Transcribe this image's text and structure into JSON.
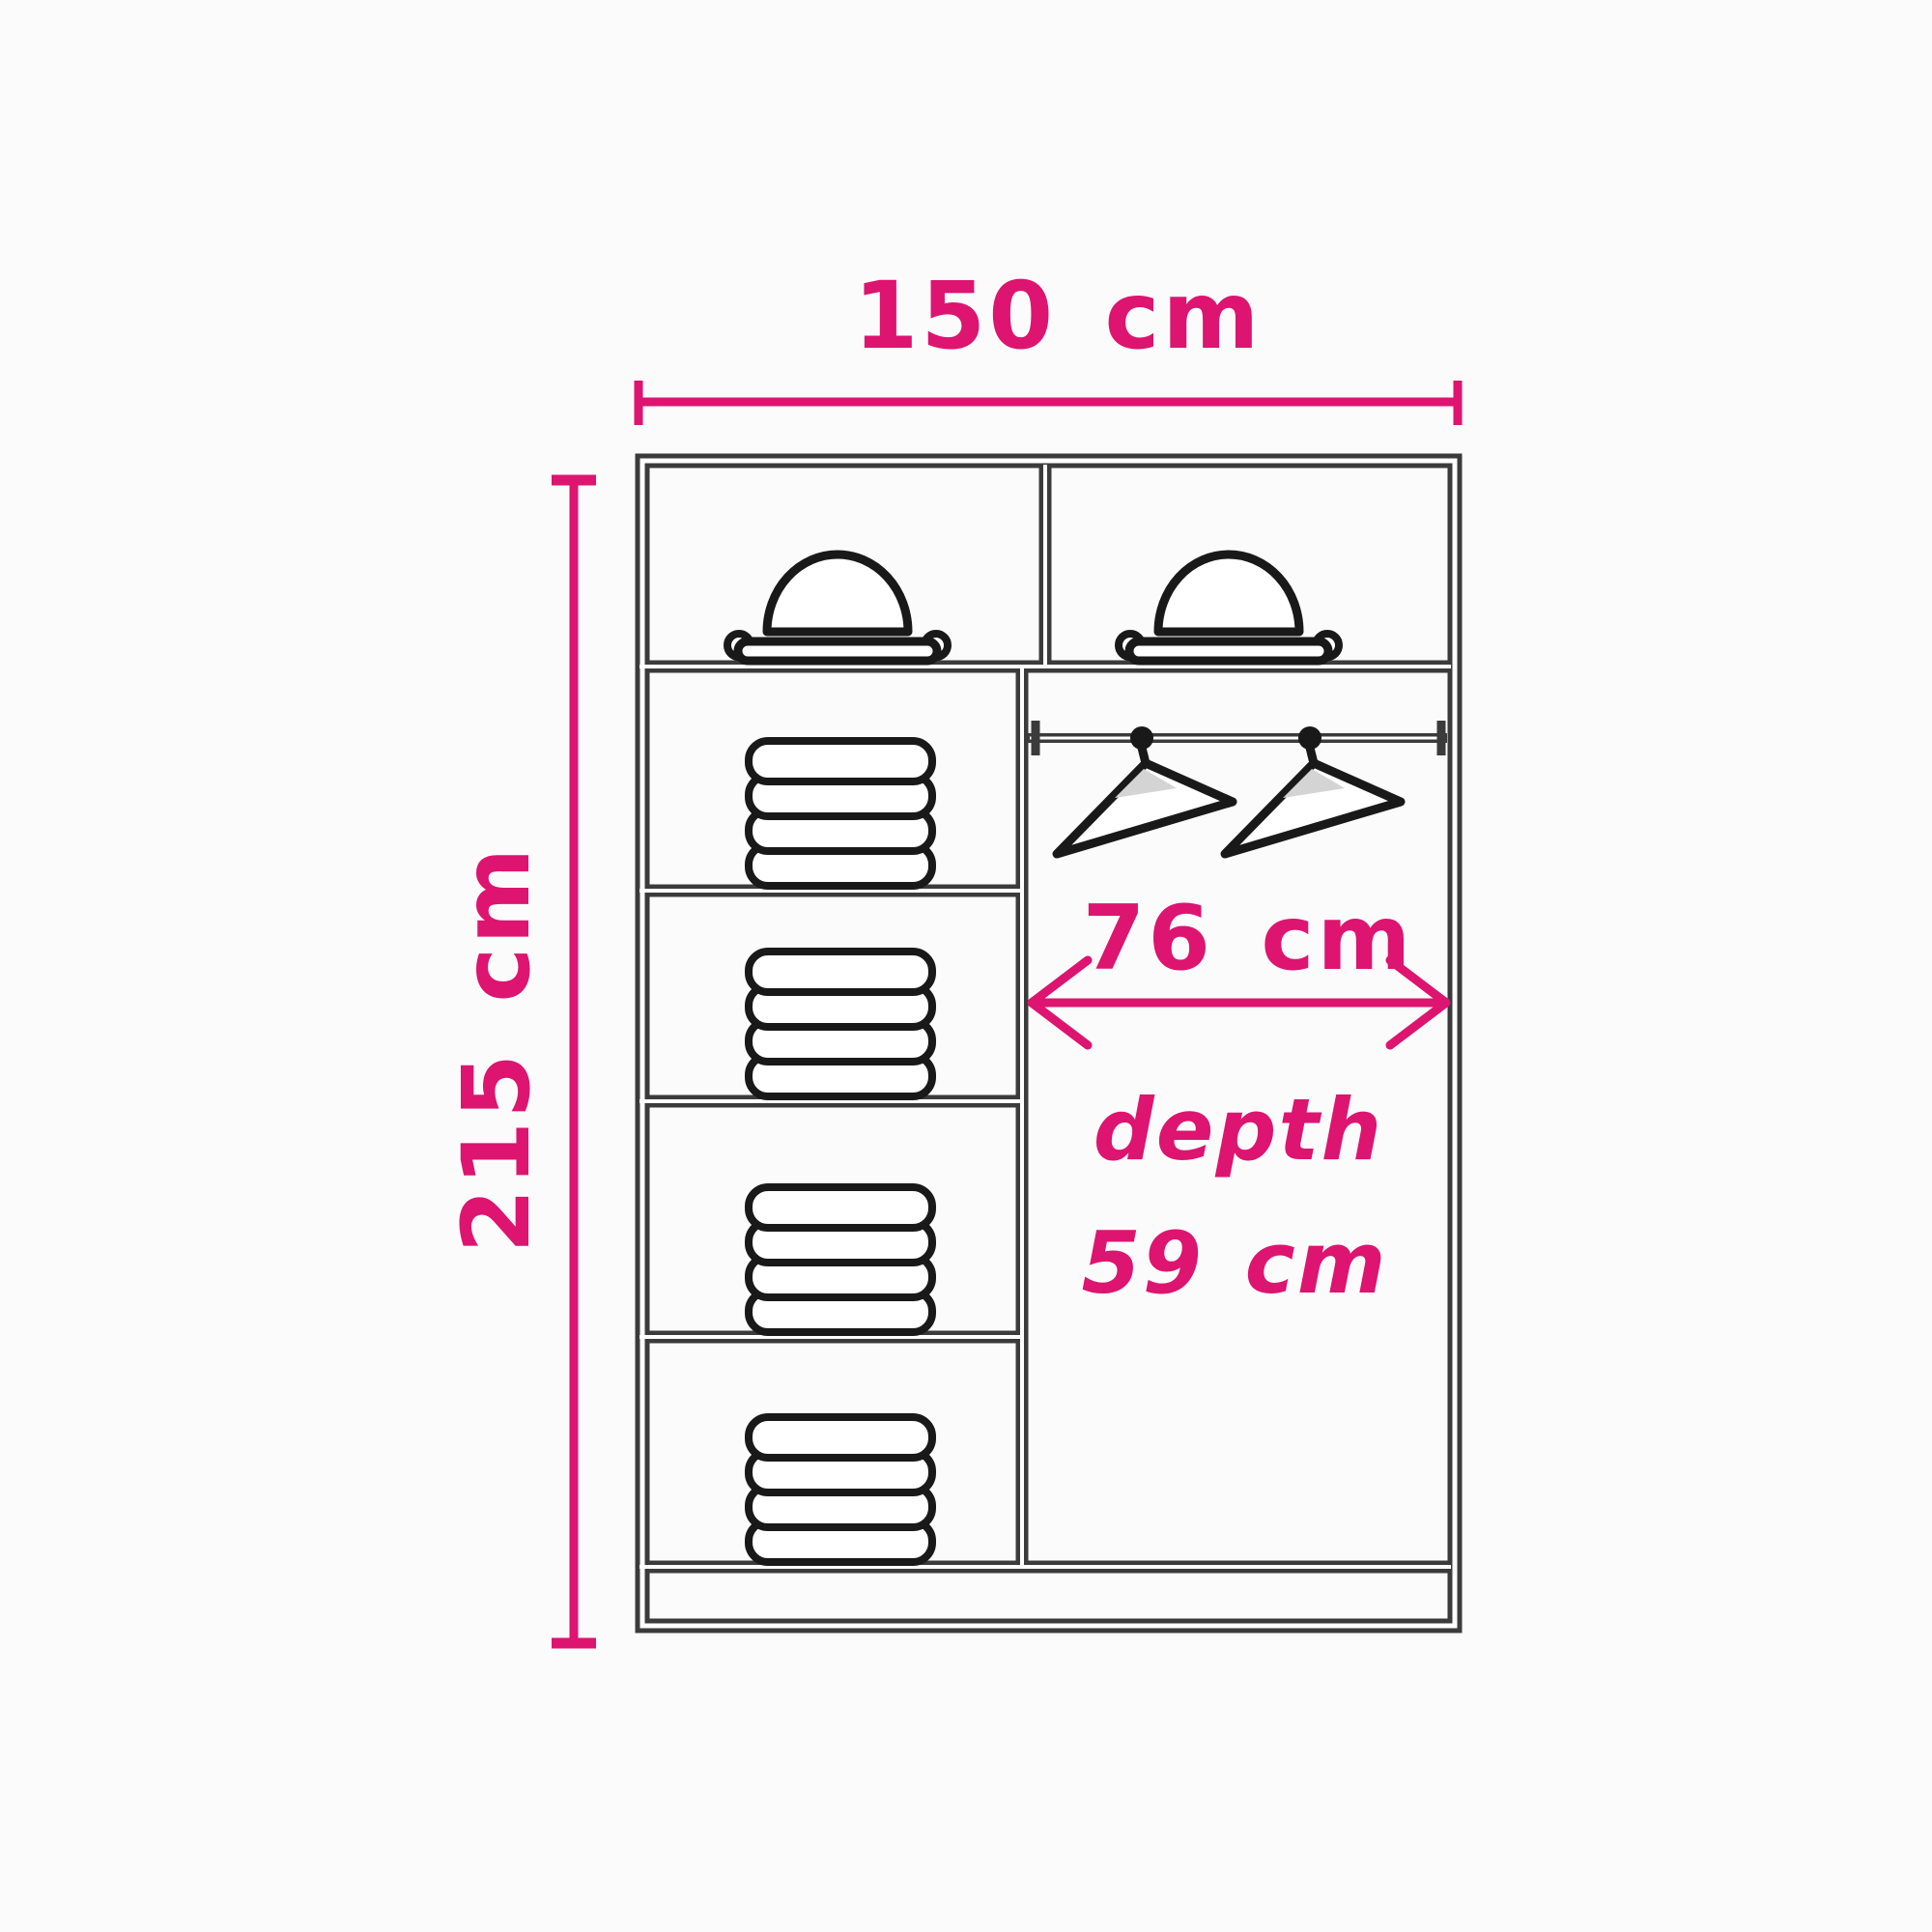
{
  "diagram": {
    "description": "wardrobe interior dimension diagram",
    "dimensions": {
      "width_label": "150 cm",
      "height_label": "215 cm",
      "hanging_section_width_label": "76 cm",
      "depth_word": "depth",
      "depth_value_label": "59 cm"
    },
    "colors": {
      "dimension_accent": "#dd1470",
      "wall_outline": "#3b3b3b",
      "icon_outline": "#191919",
      "clothes_fill": "#e8e8e8",
      "background": "#fbfbfb"
    },
    "contents": {
      "hat_compartments": 2,
      "folded_clothes_stacks": 4,
      "hangers_on_rail": 2
    }
  }
}
